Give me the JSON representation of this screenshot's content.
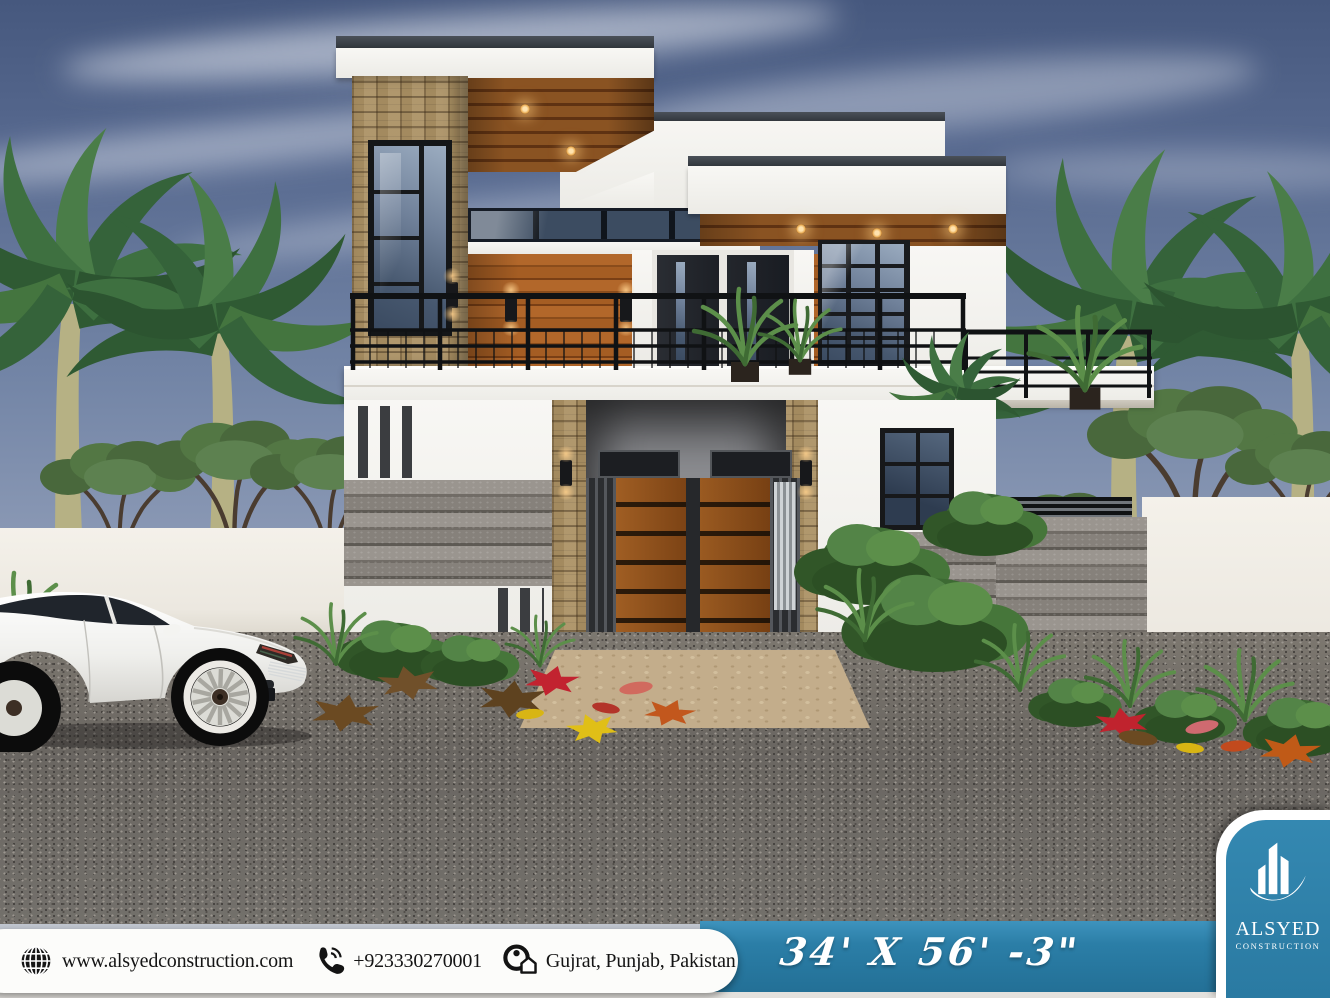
{
  "poster": {
    "footer": {
      "website": "www.alsyedconstruction.com",
      "phone": "+923330270001",
      "location": "Gujrat, Punjab, Pakistan",
      "plot_size": "34' X 56' -3\""
    },
    "brand": {
      "name": "ALSYED",
      "subtitle": "CONSTRUCTION"
    },
    "colors": {
      "accent_blue": "#2b7ea7",
      "footer_white": "#fcfcfa"
    },
    "icons": {
      "website": "globe-icon",
      "phone": "phone-handset-icon",
      "location": "map-pin-house-icon",
      "brand": "building-skyline-icon"
    }
  }
}
